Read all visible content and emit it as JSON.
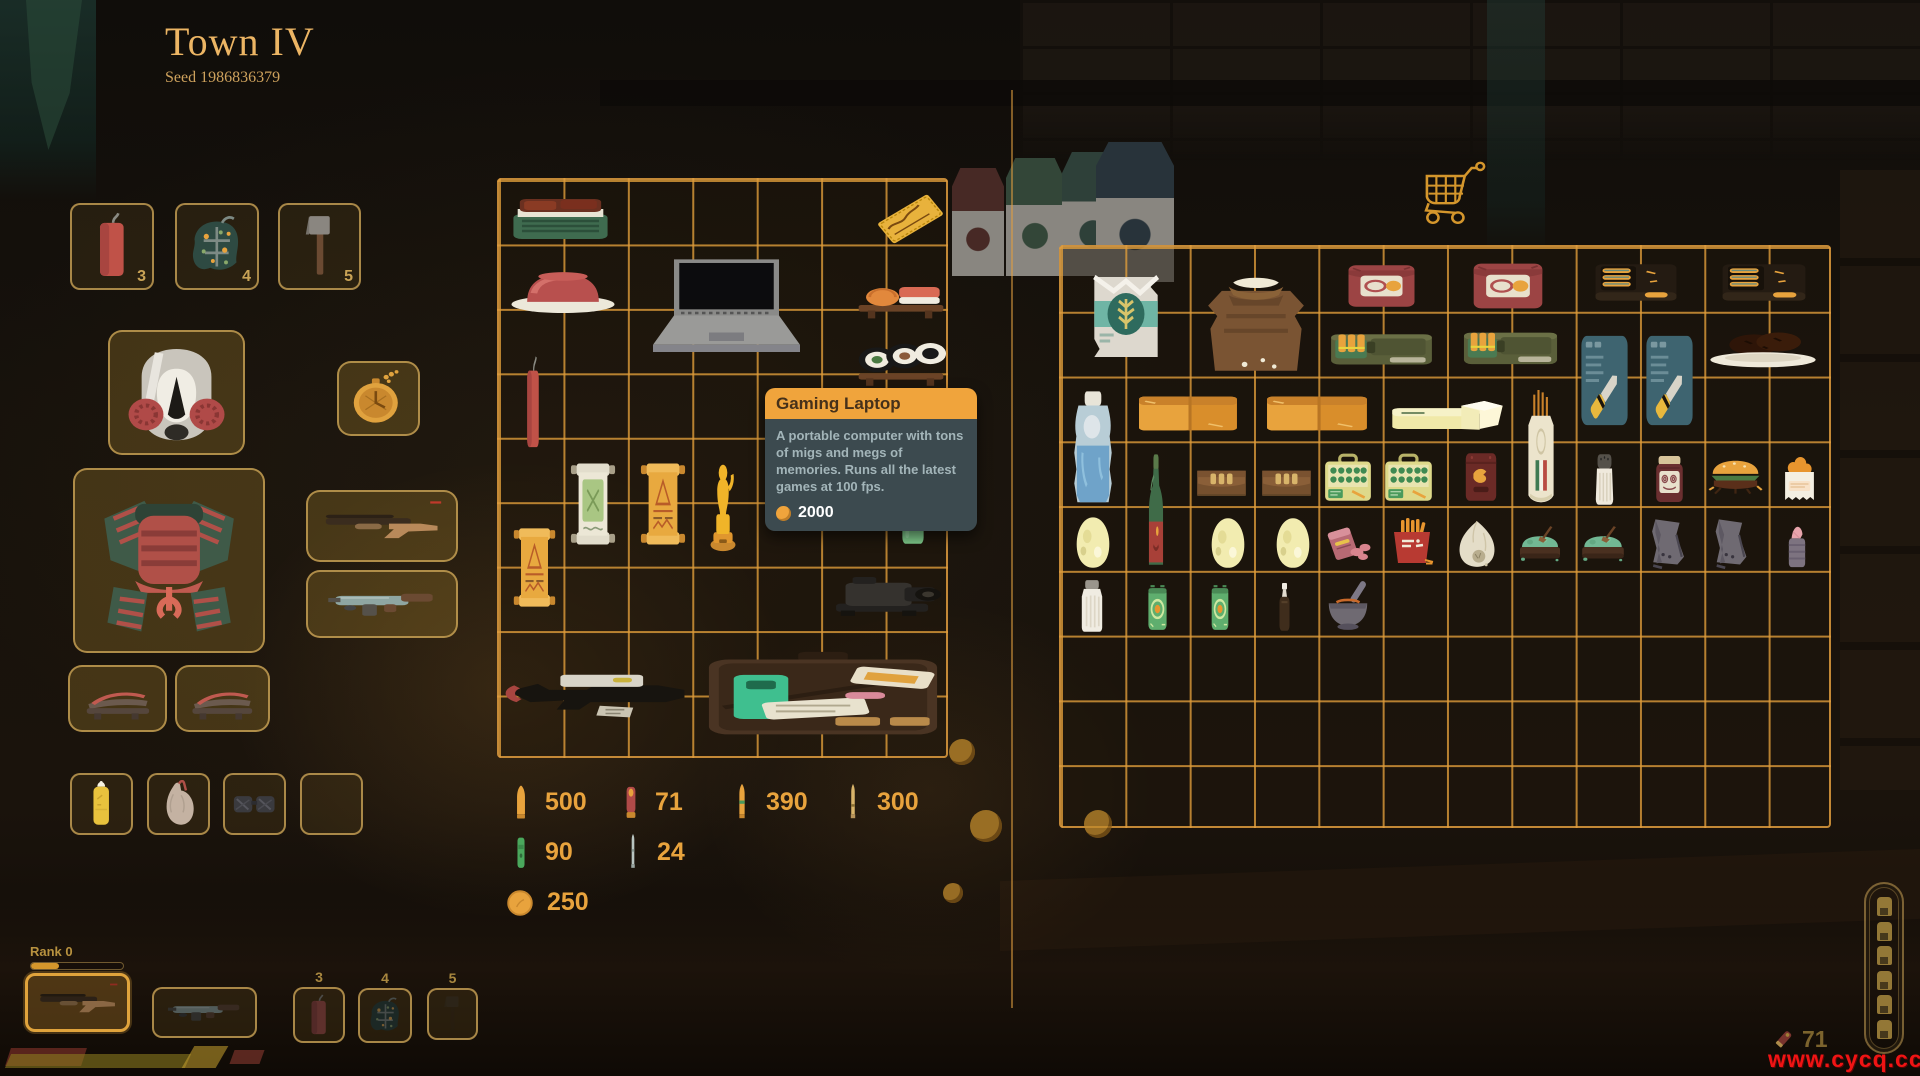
{
  "header": {
    "title": "Town IV",
    "seed": "Seed 1986836379"
  },
  "tooltip": {
    "title": "Gaming Laptop",
    "description": "A portable computer with tons of migs and megs of memories. Runs all the latest games at 100 fps.",
    "price": "2000"
  },
  "rank": {
    "label": "Rank 0",
    "progress": 0.3
  },
  "hud": {
    "coins": "71",
    "shell_bar_count": 6
  },
  "watermark": {
    "text": "www.cycq.cc"
  },
  "colors": {
    "grid_line": "rgba(222,156,58,0.8)",
    "accent_gold": "#c9a356",
    "tooltip_header": "#f0a43c"
  },
  "equipment": {
    "slots": [
      {
        "name": "quick-slot-3",
        "icon": "dynamite-stick",
        "label": "3",
        "labelPos": "in",
        "x": 70,
        "y": 203,
        "w": 84,
        "h": 87
      },
      {
        "name": "quick-slot-4",
        "icon": "camo-grenade",
        "label": "4",
        "labelPos": "in",
        "x": 175,
        "y": 203,
        "w": 84,
        "h": 87
      },
      {
        "name": "quick-slot-5",
        "icon": "hatchet",
        "label": "5",
        "labelPos": "in",
        "x": 278,
        "y": 203,
        "w": 83,
        "h": 87
      },
      {
        "name": "amulet-slot",
        "icon": "pocket-watch",
        "tone": "equip",
        "x": 337,
        "y": 361,
        "w": 83,
        "h": 75
      },
      {
        "name": "head-slot",
        "icon": "gas-mask",
        "tone": "equip",
        "x": 108,
        "y": 330,
        "w": 137,
        "h": 125
      },
      {
        "name": "body-slot",
        "icon": "samurai-armor",
        "tone": "equip",
        "x": 73,
        "y": 468,
        "w": 192,
        "h": 185
      },
      {
        "name": "foot-slot-left",
        "icon": "sandal",
        "tone": "equip",
        "x": 68,
        "y": 665,
        "w": 99,
        "h": 67
      },
      {
        "name": "foot-slot-right",
        "icon": "sandal",
        "tone": "equip",
        "x": 175,
        "y": 665,
        "w": 95,
        "h": 67
      },
      {
        "name": "weapon-slot-shotgun",
        "icon": "shotgun",
        "tone": "equip",
        "x": 306,
        "y": 490,
        "w": 152,
        "h": 72
      },
      {
        "name": "weapon-slot-smg",
        "icon": "smg",
        "tone": "equip",
        "x": 306,
        "y": 570,
        "w": 152,
        "h": 68
      },
      {
        "name": "misc-slot-lighter",
        "icon": "yellow-bottle",
        "x": 70,
        "y": 773,
        "w": 63,
        "h": 62
      },
      {
        "name": "misc-slot-organ",
        "icon": "organ",
        "x": 147,
        "y": 773,
        "w": 63,
        "h": 62
      },
      {
        "name": "misc-slot-goggles",
        "icon": "goggles",
        "x": 223,
        "y": 773,
        "w": 63,
        "h": 62
      },
      {
        "name": "misc-slot-empty",
        "x": 300,
        "y": 773,
        "w": 63,
        "h": 62
      }
    ]
  },
  "player_grid": {
    "x": 497,
    "y": 178,
    "w": 451,
    "h": 580,
    "cols": 7,
    "rows": 9,
    "items": [
      {
        "name": "bbq-tray",
        "icon": "bbq-tray",
        "x": 8,
        "y": 15,
        "w": 107,
        "h": 50
      },
      {
        "name": "golden-ticket",
        "icon": "golden-ticket",
        "x": 375,
        "y": 8,
        "w": 73,
        "h": 62
      },
      {
        "name": "ham-plate",
        "icon": "ham-plate",
        "x": 8,
        "y": 76,
        "w": 112,
        "h": 62
      },
      {
        "name": "gaming-laptop",
        "icon": "laptop",
        "x": 140,
        "y": 72,
        "w": 175,
        "h": 122
      },
      {
        "name": "sushi-nigiri",
        "icon": "sushi-nigiri",
        "x": 356,
        "y": 88,
        "w": 92,
        "h": 56
      },
      {
        "name": "dynamite",
        "icon": "dynamite-stick",
        "x": 18,
        "y": 175,
        "w": 32,
        "h": 98
      },
      {
        "name": "sushi-maki",
        "icon": "sushi-maki",
        "x": 356,
        "y": 150,
        "w": 92,
        "h": 62
      },
      {
        "name": "scroll-white",
        "icon": "scroll-white",
        "x": 70,
        "y": 280,
        "w": 48,
        "h": 88
      },
      {
        "name": "scroll-orange",
        "icon": "scroll-orange",
        "x": 140,
        "y": 280,
        "w": 48,
        "h": 88
      },
      {
        "name": "trophy",
        "icon": "trophy",
        "x": 200,
        "y": 282,
        "w": 48,
        "h": 90
      },
      {
        "name": "shot-glass",
        "icon": "shot-glass",
        "x": 395,
        "y": 298,
        "w": 38,
        "h": 70
      },
      {
        "name": "scroll-orange-2",
        "icon": "scroll-orange",
        "x": 13,
        "y": 345,
        "w": 45,
        "h": 85
      },
      {
        "name": "camera-scope",
        "icon": "camera-scope",
        "x": 330,
        "y": 390,
        "w": 118,
        "h": 58
      },
      {
        "name": "black-rifle",
        "icon": "black-rifle",
        "x": 5,
        "y": 478,
        "w": 188,
        "h": 76
      },
      {
        "name": "briefcase-kit",
        "icon": "briefcase-kit",
        "x": 200,
        "y": 468,
        "w": 248,
        "h": 96
      }
    ]
  },
  "shop_grid": {
    "x": 1059,
    "y": 245,
    "w": 772,
    "h": 583,
    "cols": 12,
    "rows": 9,
    "items": [
      {
        "name": "flour-bag",
        "icon": "flour-bag",
        "x": 21,
        "y": 20,
        "w": 88,
        "h": 100
      },
      {
        "name": "flour-sack",
        "icon": "flour-sack",
        "x": 138,
        "y": 25,
        "w": 114,
        "h": 105
      },
      {
        "name": "canned-meat-1",
        "icon": "canned-meat",
        "x": 283,
        "y": 13,
        "w": 75,
        "h": 52
      },
      {
        "name": "canned-meat-2",
        "icon": "canned-meat",
        "x": 408,
        "y": 11,
        "w": 78,
        "h": 56
      },
      {
        "name": "rat-trap-1",
        "icon": "rat-trap",
        "x": 531,
        "y": 12,
        "w": 88,
        "h": 52
      },
      {
        "name": "rat-trap-2",
        "icon": "rat-trap",
        "x": 658,
        "y": 12,
        "w": 90,
        "h": 52
      },
      {
        "name": "ammo-can-1",
        "icon": "ammo-can",
        "x": 268,
        "y": 77,
        "w": 105,
        "h": 52
      },
      {
        "name": "ammo-can-2",
        "icon": "ammo-can",
        "x": 401,
        "y": 75,
        "w": 97,
        "h": 54
      },
      {
        "name": "knife-kit-1",
        "icon": "knife-kit",
        "x": 516,
        "y": 85,
        "w": 55,
        "h": 97
      },
      {
        "name": "knife-kit-2",
        "icon": "knife-kit",
        "x": 581,
        "y": 85,
        "w": 55,
        "h": 97
      },
      {
        "name": "cookies-plate",
        "icon": "cookies-plate",
        "x": 646,
        "y": 78,
        "w": 112,
        "h": 47
      },
      {
        "name": "water-jug",
        "icon": "water-jug",
        "x": 6,
        "y": 142,
        "w": 52,
        "h": 118
      },
      {
        "name": "orange-crate-1",
        "icon": "orange-crate",
        "x": 76,
        "y": 143,
        "w": 102,
        "h": 47
      },
      {
        "name": "orange-crate-2",
        "icon": "orange-crate",
        "x": 204,
        "y": 143,
        "w": 104,
        "h": 47
      },
      {
        "name": "butter-block",
        "icon": "butter",
        "x": 329,
        "y": 150,
        "w": 115,
        "h": 40
      },
      {
        "name": "baguette",
        "icon": "baguette",
        "x": 459,
        "y": 143,
        "w": 42,
        "h": 117
      },
      {
        "name": "wine-bottle",
        "icon": "wine-bottle",
        "x": 79,
        "y": 205,
        "w": 32,
        "h": 120
      },
      {
        "name": "ammo-wallet-1",
        "icon": "wallet",
        "x": 133,
        "y": 213,
        "w": 55,
        "h": 45
      },
      {
        "name": "ammo-wallet-2",
        "icon": "wallet",
        "x": 198,
        "y": 213,
        "w": 55,
        "h": 45
      },
      {
        "name": "shell-box-1",
        "icon": "green-ammo-box",
        "x": 261,
        "y": 205,
        "w": 52,
        "h": 53
      },
      {
        "name": "shell-box-2",
        "icon": "green-ammo-box",
        "x": 321,
        "y": 205,
        "w": 53,
        "h": 53
      },
      {
        "name": "red-pouch",
        "icon": "red-pouch",
        "x": 401,
        "y": 203,
        "w": 38,
        "h": 54
      },
      {
        "name": "spice-shaker",
        "icon": "spice-shaker",
        "x": 529,
        "y": 205,
        "w": 29,
        "h": 55
      },
      {
        "name": "jam-jar",
        "icon": "jam-jar",
        "x": 589,
        "y": 208,
        "w": 39,
        "h": 50
      },
      {
        "name": "burger",
        "icon": "burger",
        "x": 646,
        "y": 210,
        "w": 57,
        "h": 47
      },
      {
        "name": "snack-cup",
        "icon": "snack-cup",
        "x": 716,
        "y": 208,
        "w": 45,
        "h": 50
      },
      {
        "name": "egg-1",
        "icon": "egg",
        "x": 8,
        "y": 267,
        "w": 48,
        "h": 56
      },
      {
        "name": "egg-2",
        "icon": "egg",
        "x": 143,
        "y": 268,
        "w": 48,
        "h": 55
      },
      {
        "name": "egg-3",
        "icon": "egg",
        "x": 208,
        "y": 268,
        "w": 48,
        "h": 55
      },
      {
        "name": "sausage-box",
        "icon": "sausage-box",
        "x": 263,
        "y": 272,
        "w": 50,
        "h": 46
      },
      {
        "name": "fries-box",
        "icon": "fries-box",
        "x": 326,
        "y": 270,
        "w": 50,
        "h": 50
      },
      {
        "name": "garlic-sack",
        "icon": "garlic-sack",
        "x": 393,
        "y": 270,
        "w": 46,
        "h": 53
      },
      {
        "name": "herb-tray-1",
        "icon": "herb-tray",
        "x": 454,
        "y": 277,
        "w": 50,
        "h": 41
      },
      {
        "name": "herb-tray-2",
        "icon": "herb-tray",
        "x": 516,
        "y": 277,
        "w": 52,
        "h": 41
      },
      {
        "name": "armor-piece-1",
        "icon": "armor-piece",
        "x": 579,
        "y": 268,
        "w": 55,
        "h": 55
      },
      {
        "name": "armor-piece-2",
        "icon": "armor-piece",
        "x": 643,
        "y": 268,
        "w": 53,
        "h": 55
      },
      {
        "name": "pink-can",
        "icon": "pink-can",
        "x": 719,
        "y": 275,
        "w": 34,
        "h": 48
      },
      {
        "name": "milk-bottle",
        "icon": "milk-bottle",
        "x": 14,
        "y": 332,
        "w": 34,
        "h": 55
      },
      {
        "name": "green-can-1",
        "icon": "green-can",
        "x": 79,
        "y": 335,
        "w": 35,
        "h": 52
      },
      {
        "name": "green-can-2",
        "icon": "green-can",
        "x": 143,
        "y": 335,
        "w": 32,
        "h": 52
      },
      {
        "name": "dropper-bottle",
        "icon": "dropper-bottle",
        "x": 211,
        "y": 335,
        "w": 25,
        "h": 53
      },
      {
        "name": "mortar-pestle",
        "icon": "mortar-pestle",
        "x": 263,
        "y": 332,
        "w": 48,
        "h": 53
      }
    ]
  },
  "ammo_counts": [
    {
      "icon": "pistol-round",
      "value": "500",
      "x": 510,
      "y": 784
    },
    {
      "icon": "shotgun-shell",
      "value": "71",
      "x": 620,
      "y": 784
    },
    {
      "icon": "rifle-round",
      "value": "390",
      "x": 731,
      "y": 784
    },
    {
      "icon": "sniper-round",
      "value": "300",
      "x": 842,
      "y": 784
    },
    {
      "icon": "special-round",
      "value": "90",
      "x": 510,
      "y": 834
    },
    {
      "icon": "long-round",
      "value": "24",
      "x": 622,
      "y": 834
    },
    {
      "icon": "coin",
      "value": "250",
      "x": 506,
      "y": 888
    }
  ],
  "hotbar": {
    "slots": [
      {
        "name": "hotbar-slot-1",
        "icon": "shotgun",
        "selected": true,
        "x": 25,
        "y": 973,
        "w": 105,
        "h": 59
      },
      {
        "name": "hotbar-slot-2",
        "icon": "smg",
        "x": 152,
        "y": 987,
        "w": 105,
        "h": 51
      },
      {
        "name": "hotbar-slot-3",
        "icon": "dynamite-stick",
        "label": "3",
        "labelPos": "above",
        "x": 293,
        "y": 987,
        "w": 52,
        "h": 56
      },
      {
        "name": "hotbar-slot-4",
        "icon": "camo-grenade",
        "label": "4",
        "labelPos": "above",
        "x": 358,
        "y": 988,
        "w": 54,
        "h": 55
      },
      {
        "name": "hotbar-slot-5",
        "icon": "hatchet",
        "dim": true,
        "label": "5",
        "labelPos": "above",
        "x": 427,
        "y": 988,
        "w": 51,
        "h": 52
      }
    ]
  },
  "floor_coins": [
    {
      "x": 962,
      "y": 752,
      "r": 13
    },
    {
      "x": 986,
      "y": 826,
      "r": 16
    },
    {
      "x": 1098,
      "y": 824,
      "r": 14
    },
    {
      "x": 953,
      "y": 893,
      "r": 10
    }
  ],
  "milk_cartons": [
    {
      "x": 952,
      "y": 168,
      "w": 52,
      "h": 108,
      "color": "#7a4038"
    },
    {
      "x": 1006,
      "y": 158,
      "w": 58,
      "h": 118,
      "color": "#4f7257"
    },
    {
      "x": 1062,
      "y": 152,
      "w": 62,
      "h": 124,
      "color": "#47685c"
    },
    {
      "x": 1096,
      "y": 142,
      "w": 78,
      "h": 140,
      "color": "#3e5360"
    }
  ]
}
